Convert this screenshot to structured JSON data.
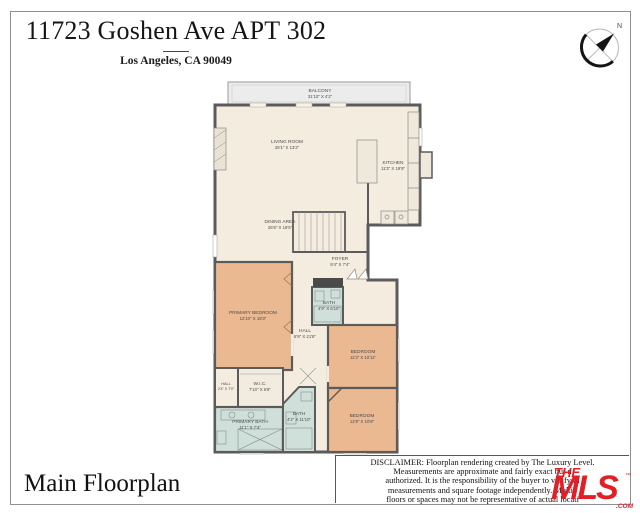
{
  "header": {
    "title": "11723 Goshen Ave APT 302",
    "subtitle": "Los Angeles, CA 90049"
  },
  "compass": {
    "north_label": "N"
  },
  "floorplan": {
    "colors": {
      "floor": "#f4ecdf",
      "bedroom": "#eab992",
      "bath": "#cfe0da",
      "balcony": "#ececec",
      "wall": "#5b5b5b"
    },
    "rooms": {
      "balcony": {
        "name": "BALCONY",
        "dims": "31'10\" X 4'2\""
      },
      "living_room": {
        "name": "LIVING ROOM",
        "dims": "25'1\" X 13'2\""
      },
      "kitchen": {
        "name": "KITCHEN",
        "dims": "11'3\" X 19'9\""
      },
      "dining_area": {
        "name": "DINING AREA",
        "dims": "26'6\" X 18'5\""
      },
      "foyer": {
        "name": "FOYER",
        "dims": "9'4\" X 7'4\""
      },
      "primary_bedroom": {
        "name": "PRIMARY BEDROOM",
        "dims": "12'10\" X 18'3\""
      },
      "bath_upper": {
        "name": "BATH",
        "dims": "4'9\" X 6'10\""
      },
      "hall": {
        "name": "HALL",
        "dims": "6'9\" X 21'8\""
      },
      "bedroom_mid": {
        "name": "BEDROOM",
        "dims": "11'3\" X 10'11\""
      },
      "bedroom_lower": {
        "name": "BEDROOM",
        "dims": "12'8\" X 10'8\""
      },
      "wic": {
        "name": "W.I.C.",
        "dims": "7'10\" X 6'8\""
      },
      "hall_small": {
        "name": "HALL",
        "dims": "2'4\" X 7'0\""
      },
      "primary_bath": {
        "name": "PRIMARY BATH",
        "dims": "11'1\" X 7'4\""
      },
      "bath_mid": {
        "name": "BATH",
        "dims": "4'2\" X 11'10\""
      }
    }
  },
  "footer": {
    "caption": "Main Floorplan",
    "disclaimer_lines": [
      "DISCLAIMER: Floorplan rendering created by The Luxury Level.",
      "Measurements are approximate and fairly exact but n",
      "authorized. It is the responsibility of the buyer to verify th",
      "measurements and square footage independently. Multip",
      "floors or spaces may not be representative of actual locati"
    ],
    "logo": {
      "the": "THE",
      "mls": "MLS",
      "tm": "™",
      "com": ".COM",
      "color": "#e31e26"
    }
  }
}
